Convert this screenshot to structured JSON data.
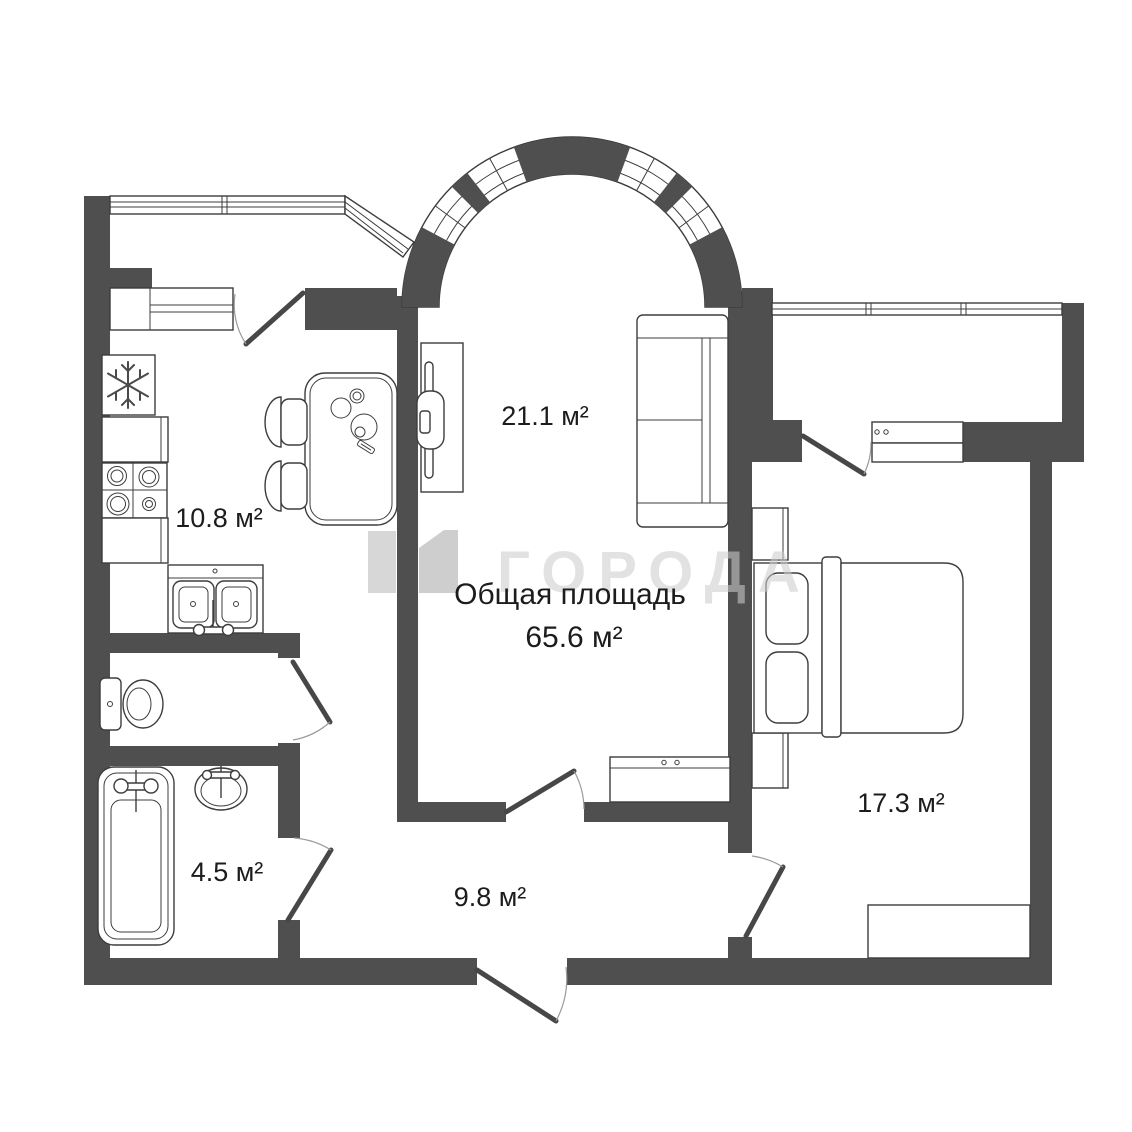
{
  "watermark": {
    "text": "ГОРОДА",
    "logo_color_left": "#bfbfbf",
    "logo_color_right": "#b0b0b0"
  },
  "summary": {
    "label": "Общая площадь",
    "value": "65.6 м²"
  },
  "rooms": {
    "living": {
      "name": "living-room",
      "area": "21.1 м²"
    },
    "kitchen": {
      "name": "kitchen",
      "area": "10.8 м²"
    },
    "bedroom": {
      "name": "bedroom",
      "area": "17.3 м²"
    },
    "bathroom": {
      "name": "bathroom",
      "area": "4.5 м²"
    },
    "hallway": {
      "name": "hallway",
      "area": "9.8 м²"
    }
  },
  "colors": {
    "wall": "#4f4f4f",
    "line": "#3d3d3d",
    "label": "#1c1c1c",
    "watermark": "#cccccc"
  }
}
